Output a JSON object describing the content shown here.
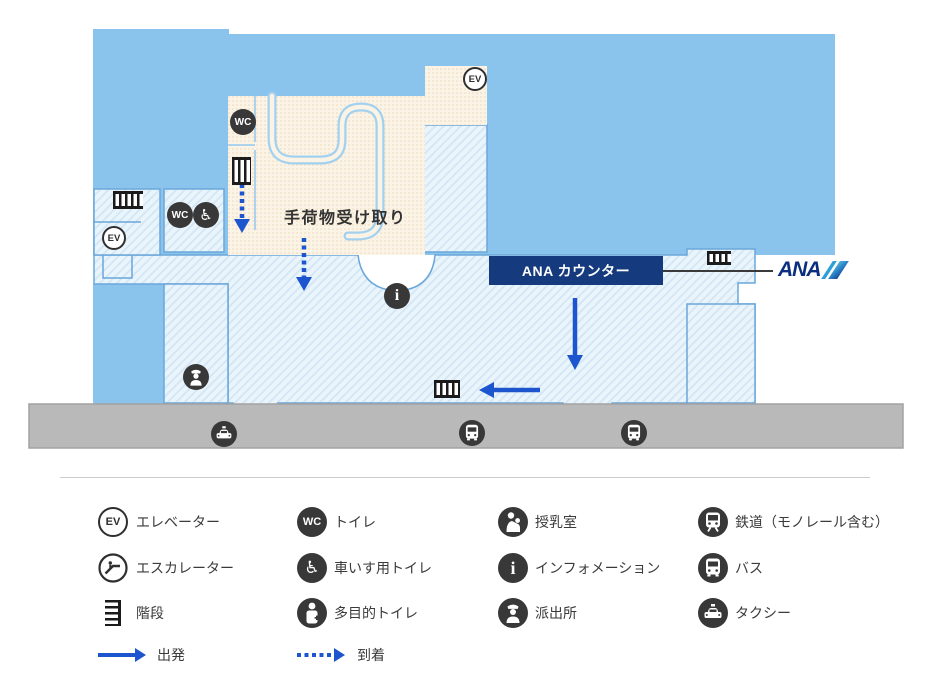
{
  "map": {
    "baggage_claim_label": "手荷物受け取り",
    "ana_counter_label": "ANA カウンター",
    "ana_logo_text": "ANA",
    "ev_label": "EV",
    "wc_label": "WC",
    "info_label": "i"
  },
  "legend": {
    "items": [
      {
        "id": "elevator",
        "label": "エレベーター"
      },
      {
        "id": "escalator",
        "label": "エスカレーター"
      },
      {
        "id": "stairs",
        "label": "階段"
      },
      {
        "id": "departure",
        "label": "出発"
      },
      {
        "id": "toilet",
        "label": "トイレ"
      },
      {
        "id": "wheelchair-toilet",
        "label": "車いす用トイレ"
      },
      {
        "id": "multipurpose-toilet",
        "label": "多目的トイレ"
      },
      {
        "id": "arrival",
        "label": "到着"
      },
      {
        "id": "nursing-room",
        "label": "授乳室"
      },
      {
        "id": "information",
        "label": "インフォメーション"
      },
      {
        "id": "police-box",
        "label": "派出所"
      },
      {
        "id": "railway",
        "label": "鉄道（モノレール含む）"
      },
      {
        "id": "bus",
        "label": "バス"
      },
      {
        "id": "taxi",
        "label": "タクシー"
      }
    ]
  },
  "colors": {
    "solid_blue": "#8AC3EC",
    "hatch_base": "#EAF4FB",
    "hatch_line": "#D2E6F6",
    "room_border": "#6BA7DA",
    "beige": "#FBF3E5",
    "beige_dot": "#ECD9BA",
    "belt": "#A2D1EF",
    "navy": "#153A7D",
    "ana_blue": "#0C2E80",
    "road_gray": "#B9B9B9",
    "arrow_blue": "#1D55CF",
    "icon_dark": "#383838"
  }
}
